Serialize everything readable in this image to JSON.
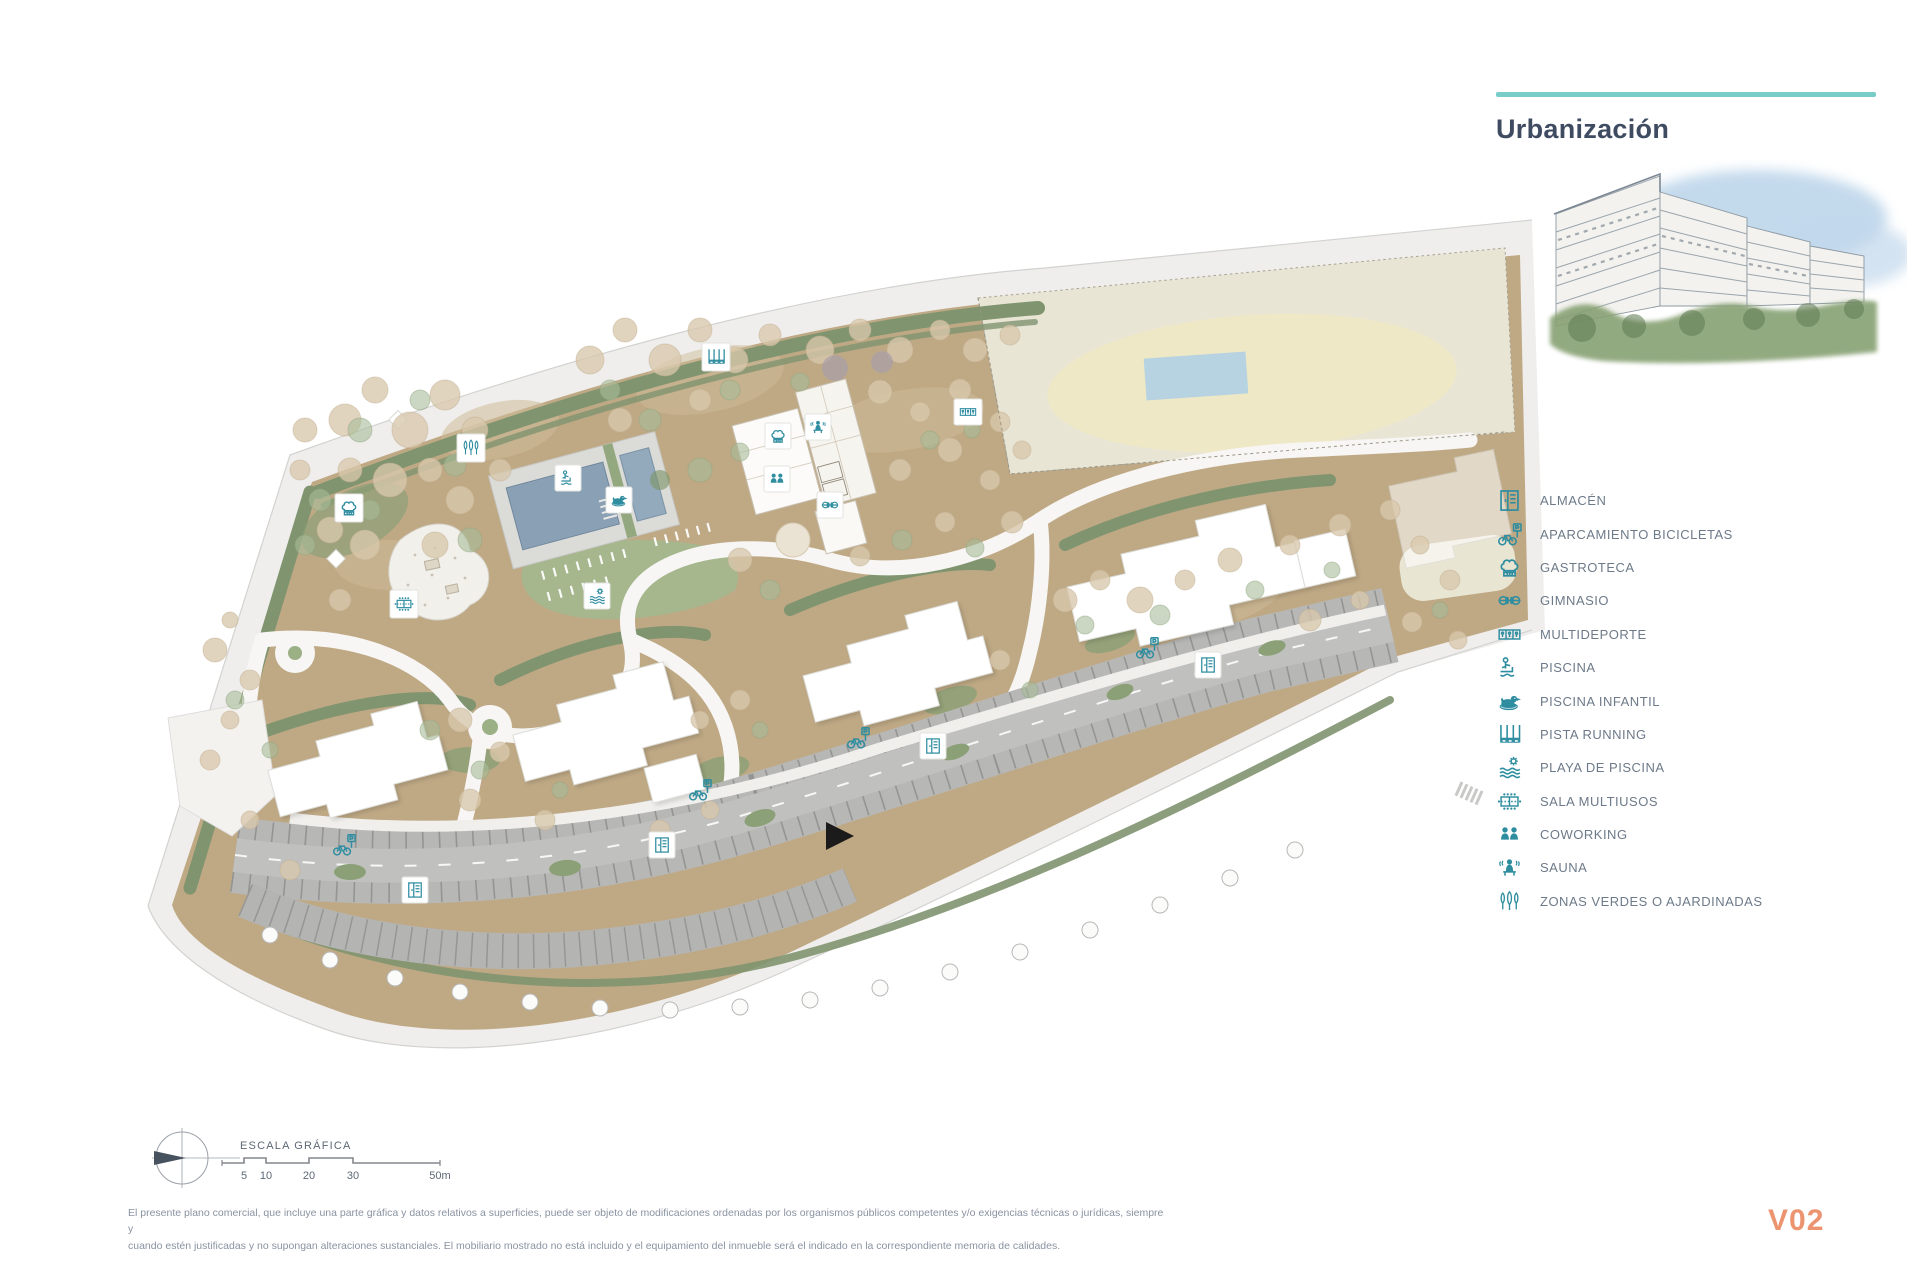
{
  "panel": {
    "title": "Urbanización",
    "legend": [
      {
        "icon": "storage-icon",
        "label": "ALMACÉN"
      },
      {
        "icon": "bicycle-parking-icon",
        "label": "APARCAMIENTO BICICLETAS"
      },
      {
        "icon": "chef-hat-icon",
        "label": "GASTROTECA"
      },
      {
        "icon": "dumbbell-icon",
        "label": "GIMNASIO"
      },
      {
        "icon": "sports-court-icon",
        "label": "MULTIDEPORTE"
      },
      {
        "icon": "pool-icon",
        "label": "PISCINA"
      },
      {
        "icon": "duck-float-icon",
        "label": "PISCINA INFANTIL"
      },
      {
        "icon": "running-track-icon",
        "label": "PISTA RUNNING"
      },
      {
        "icon": "sun-waves-icon",
        "label": "PLAYA DE PISCINA"
      },
      {
        "icon": "multiuse-room-icon",
        "label": "SALA MULTIUSOS"
      },
      {
        "icon": "coworking-icon",
        "label": "COWORKING"
      },
      {
        "icon": "sauna-icon",
        "label": "SAUNA"
      },
      {
        "icon": "trees-icon",
        "label": "ZONAS VERDES O AJARDINADAS"
      }
    ]
  },
  "scalebar": {
    "title": "ESCALA GRÁFICA",
    "ticks": [
      "5",
      "10",
      "20",
      "30",
      "50m"
    ]
  },
  "footer": {
    "disclaimer_line1": "El presente plano comercial, que incluye una parte gráfica y datos relativos a superficies, puede ser objeto de modificaciones ordenadas por los organismos públicos competentes y/o exigencias técnicas o jurídicas, siempre y",
    "disclaimer_line2": "cuando estén justificadas y no supongan alteraciones sustanciales. El mobiliario mostrado no está incluido y el equipamiento del inmueble será el indicado en la correspondiente memoria de calidades.",
    "sheet_code": "V02"
  },
  "colors": {
    "accent_teal": "#79cdc9",
    "icon_teal": "#2f8da0",
    "title_navy": "#3e4b60",
    "version_salmon": "#ec9470"
  }
}
